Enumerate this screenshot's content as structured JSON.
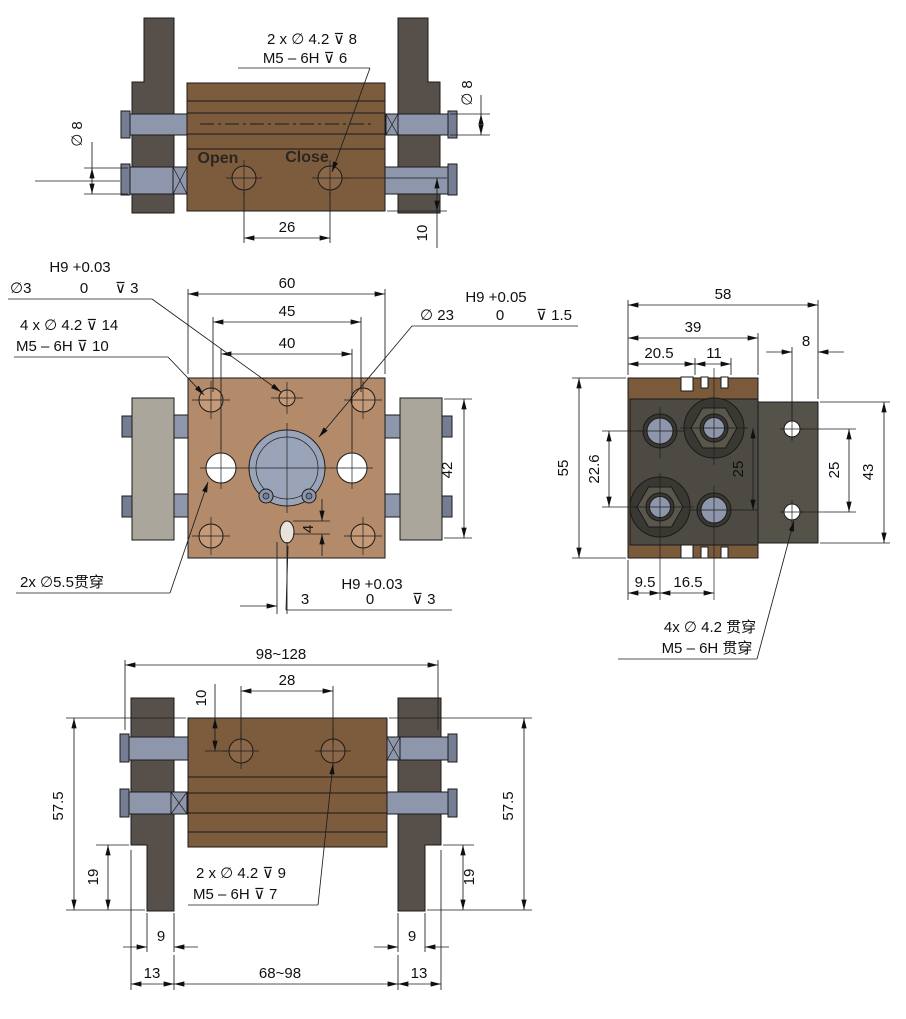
{
  "page": {
    "background": "#ffffff"
  },
  "colors": {
    "body_brown": "#7d5c3e",
    "plate_tan": "#b38a6a",
    "finger_dark": "#57504a",
    "block_gray": "#aaa69c",
    "rod_blue": "#8d96aa",
    "rod_cap": "#747d92",
    "bore_blue": "#9aa4b9",
    "lug_blue": "#8c96ac",
    "hole_tan": "#c49a78",
    "side_block": "#4c4a42",
    "side_plate": "#55524a",
    "side_brown": "#7b5a3c",
    "hex_gray": "#5a564c",
    "ring_dark": "#3a3832",
    "port_brown": "#8a6748",
    "slot_fill": "#e9e2da"
  },
  "views": {
    "top": {
      "callout_hole": "2 x ∅ 4.2  ⊽ 8",
      "callout_thread": "M5 – 6H  ⊽ 6",
      "label_open": "Open",
      "label_close": "Close",
      "dim_port_spacing": "26",
      "dim_port_height": "10",
      "dim_rod_dia_left": "∅ 8",
      "dim_rod_dia_right": "∅ 8"
    },
    "front": {
      "dim_width": "60",
      "dim_hole_spacing": "45",
      "dim_through_spacing": "40",
      "dim_block_height": "42",
      "dim_slot_offset": "4",
      "callout_center_hole": {
        "tol": "H9 +0.03",
        "dia": "∅3",
        "zero": "0",
        "depth": "⊽ 3"
      },
      "callout_corner_holes": {
        "line1": "4 x ∅ 4.2  ⊽ 14",
        "line2": "M5 – 6H  ⊽ 10"
      },
      "callout_bore": {
        "dia": "∅ 23",
        "tol": "H9 +0.05",
        "zero": "0",
        "depth": "⊽ 1.5"
      },
      "callout_through": "2x ∅5.5贯穿",
      "callout_slot": {
        "size": "3",
        "tol": "H9 +0.03",
        "zero": "0",
        "depth": "⊽ 3"
      }
    },
    "side": {
      "dim_total_width": "58",
      "dim_body_depth": "39",
      "dim_205": "20.5",
      "dim_11": "11",
      "dim_8": "8",
      "dim_height": "55",
      "dim_226": "22.6",
      "dim_25_inner": "25",
      "dim_25_plate": "25",
      "dim_43": "43",
      "dim_95": "9.5",
      "dim_165": "16.5",
      "callout_line1": "4x ∅ 4.2 贯穿",
      "callout_line2": "M5 – 6H 贯穿"
    },
    "bottom": {
      "dim_range_outer": "98~128",
      "dim_port_offset": "10",
      "dim_port_spacing": "28",
      "dim_575_left": "57.5",
      "dim_575_right": "57.5",
      "dim_19_left": "19",
      "dim_19_right": "19",
      "dim_9_left": "9",
      "dim_9_right": "9",
      "dim_13_left": "13",
      "dim_range_inner": "68~98",
      "dim_13_right": "13",
      "callout_line1": "2 x ∅ 4.2  ⊽ 9",
      "callout_line2": "M5 – 6H ⊽ 7"
    }
  }
}
